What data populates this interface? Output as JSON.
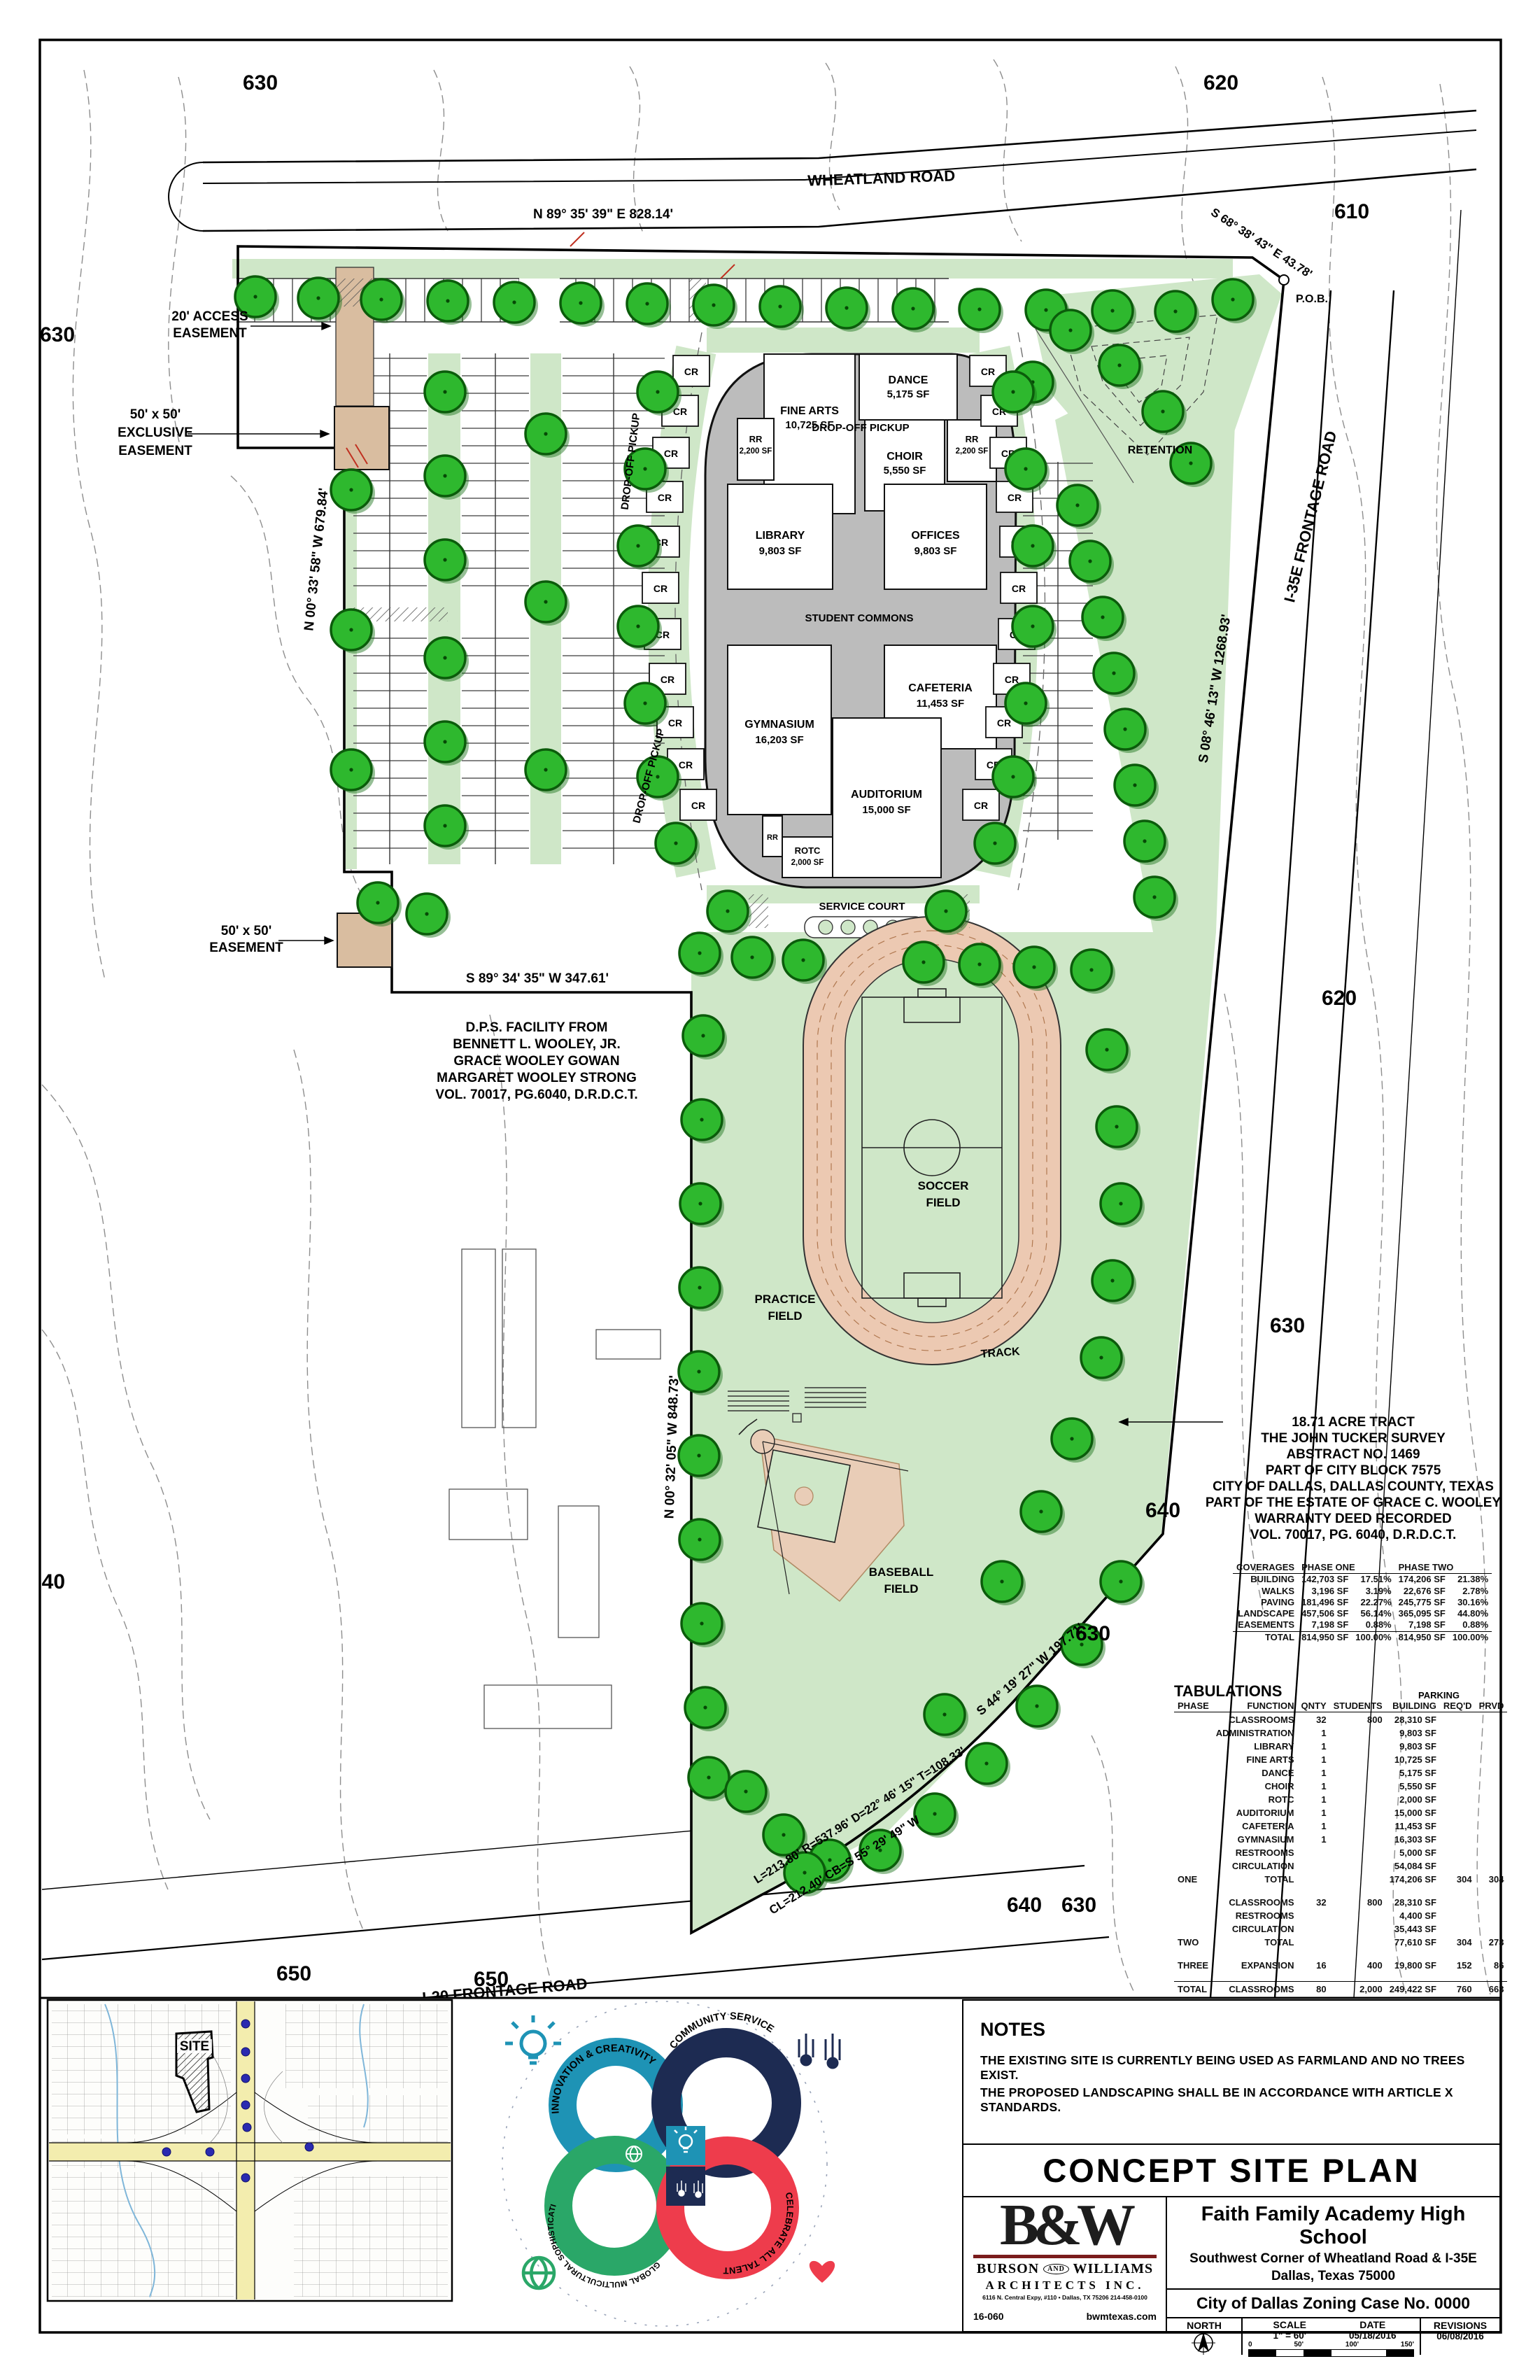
{
  "plan": {
    "roads": {
      "wheatland": "WHEATLAND ROAD",
      "i35e": "I-35E FRONTAGE ROAD",
      "i20": "I-20  FRONTAGE ROAD"
    },
    "bearings": {
      "north": "N 89° 35' 39\" E    828.14'",
      "northeast": "S 68° 38' 43\" E   43.78'",
      "pob": "P.O.B.",
      "east": "S 08° 46' 13\" W    1268.93'",
      "west_north": "N 00° 33' 58\" W    679.84'",
      "mid": "S 89° 34' 35\" W    347.61'",
      "west_south": "N 00° 32' 05\" W    848.73'",
      "southeast": "S 44° 19' 27\" W   197.71'",
      "curve1": "L=213.80'    R=537.96'    D=22° 46' 15\"    T=108.33'",
      "curve2": "CL=212.40'    CB=S 55° 29' 49\" W"
    },
    "contours": [
      "630",
      "620",
      "610",
      "630",
      "620",
      "630",
      "640",
      "630",
      "640",
      "650",
      "650",
      "640",
      "630"
    ],
    "easements": {
      "access1": "20' AC­CESS",
      "access2": "EASEMENT",
      "exclusive1": "50' x 50'",
      "exclusive2": "EXCLUSIVE",
      "exclusive3": "EASEMENT",
      "plain1": "50' x 50'",
      "plain2": "EASEMENT"
    },
    "features": {
      "retention": "RETENTION",
      "drop_off": "DROP-OFF PICKUP",
      "service_court": "SERVICE COURT",
      "practice1": "PRACTICE",
      "practice2": "FIELD",
      "soccer1": "SOCCER",
      "soccer2": "FIELD",
      "track": "TRACK",
      "baseball1": "BASEBALL",
      "baseball2": "FIELD"
    },
    "buildings": {
      "classroom": "CR",
      "fine_arts": {
        "name": "FINE ARTS",
        "area": "10,725 SF"
      },
      "dance": {
        "name": "DANCE",
        "area": "5,175 SF"
      },
      "rr_left": {
        "name": "RR",
        "area": "2,200 SF"
      },
      "choir": {
        "name": "CHOIR",
        "area": "5,550 SF"
      },
      "rr_right": {
        "name": "RR",
        "area": "2,200 SF"
      },
      "library": {
        "name": "LIBRARY",
        "area": "9,803 SF"
      },
      "offices": {
        "name": "OFFICES",
        "area": "9,803 SF"
      },
      "student_commons": {
        "name": "STUDENT COMMONS"
      },
      "gymnasium": {
        "name": "GYMNASIUM",
        "area": "16,203 SF"
      },
      "cafeteria": {
        "name": "CAFETERIA",
        "area": "11,453 SF"
      },
      "auditorium": {
        "name": "AUDITORIUM",
        "area": "15,000 SF"
      },
      "rr_small": {
        "name": "RR"
      },
      "rotc": {
        "name": "ROTC",
        "area": "2,000 SF"
      }
    },
    "dps_note": [
      "D.P.S. FACILITY FROM",
      "BENNETT L. WOOLEY, JR.",
      "GRACE WOOLEY GOWAN",
      "MARGARET WOOLEY STRONG",
      "VOL. 70017, PG.6040, D.R.D.C.T."
    ],
    "tract_note": [
      "18.71 ACRE TRACT",
      "THE JOHN TUCKER SURVEY",
      "ABSTRACT NO. 1469",
      "PART OF CITY BLOCK 7575",
      "CITY OF DALLAS, DALLAS COUNTY, TEXAS",
      "PART OF THE ESTATE OF GRACE C. WOOLEY",
      "WARRANTY DEED RECORDED",
      "VOL. 70017, PG. 6040, D.R.D.C.T."
    ]
  },
  "coverages": {
    "title": "COVERAGES",
    "phase_one": "PHASE ONE",
    "phase_two": "PHASE TWO",
    "rows": [
      {
        "label": "BUILDING",
        "p1sf": "142,703 SF",
        "p1pct": "17.51%",
        "p2sf": "174,206 SF",
        "p2pct": "21.38%"
      },
      {
        "label": "WALKS",
        "p1sf": "3,196 SF",
        "p1pct": "3.19%",
        "p2sf": "22,676 SF",
        "p2pct": "2.78%"
      },
      {
        "label": "PAVING",
        "p1sf": "181,496 SF",
        "p1pct": "22.27%",
        "p2sf": "245,775 SF",
        "p2pct": "30.16%"
      },
      {
        "label": "LANDSCAPE",
        "p1sf": "457,506 SF",
        "p1pct": "56.14%",
        "p2sf": "365,095 SF",
        "p2pct": "44.80%"
      },
      {
        "label": "EASEMENTS",
        "p1sf": "7,198 SF",
        "p1pct": "0.88%",
        "p2sf": "7,198 SF",
        "p2pct": "0.88%"
      }
    ],
    "total": {
      "label": "TOTAL",
      "p1sf": "814,950 SF",
      "p1pct": "100.00%",
      "p2sf": "814,950 SF",
      "p2pct": "100.00%"
    }
  },
  "tabulations": {
    "title": "TABULATIONS",
    "parking": "PARKING",
    "headers": {
      "phase": "PHASE",
      "function": "FUNCTION",
      "qnty": "QNTY",
      "students": "STUDENTS",
      "building": "BUILDING",
      "reqd": "REQ'D",
      "prvd": "PRVD"
    },
    "phase_one_rows": [
      {
        "fn": "CLASSROOMS",
        "qnty": "32",
        "students": "800",
        "building": "28,310 SF"
      },
      {
        "fn": "ADMINISTRATION",
        "qnty": "1",
        "students": "",
        "building": "9,803 SF"
      },
      {
        "fn": "LIBRARY",
        "qnty": "1",
        "students": "",
        "building": "9,803 SF"
      },
      {
        "fn": "FINE ARTS",
        "qnty": "1",
        "students": "",
        "building": "10,725 SF"
      },
      {
        "fn": "DANCE",
        "qnty": "1",
        "students": "",
        "building": "5,175 SF"
      },
      {
        "fn": "CHOIR",
        "qnty": "1",
        "students": "",
        "building": "5,550 SF"
      },
      {
        "fn": "ROTC",
        "qnty": "1",
        "students": "",
        "building": "2,000 SF"
      },
      {
        "fn": "AUDITORIUM",
        "qnty": "1",
        "students": "",
        "building": "15,000 SF"
      },
      {
        "fn": "CAFETERIA",
        "qnty": "1",
        "students": "",
        "building": "11,453 SF"
      },
      {
        "fn": "GYMNASIUM",
        "qnty": "1",
        "students": "",
        "building": "16,303 SF"
      },
      {
        "fn": "RESTROOMS",
        "qnty": "",
        "students": "",
        "building": "5,000 SF"
      },
      {
        "fn": "CIRCULATION",
        "qnty": "",
        "students": "",
        "building": "54,084 SF"
      }
    ],
    "phase_one_total": {
      "phase": "ONE",
      "fn": "TOTAL",
      "building": "174,206 SF",
      "reqd": "304",
      "prvd": "304"
    },
    "phase_two_rows": [
      {
        "fn": "CLASSROOMS",
        "qnty": "32",
        "students": "800",
        "building": "28,310 SF"
      },
      {
        "fn": "RESTROOMS",
        "qnty": "",
        "students": "",
        "building": "4,400 SF"
      },
      {
        "fn": "CIRCULATION",
        "qnty": "",
        "students": "",
        "building": "35,443 SF"
      }
    ],
    "phase_two_total": {
      "phase": "TWO",
      "fn": "TOTAL",
      "building": "77,610 SF",
      "reqd": "304",
      "prvd": "273"
    },
    "phase_three": {
      "phase": "THREE",
      "fn": "EXPANSION",
      "qnty": "16",
      "students": "400",
      "building": "19,800 SF",
      "reqd": "152",
      "prvd": "86"
    },
    "grand_total": {
      "phase": "TOTAL",
      "fn": "CLASSROOMS",
      "qnty": "80",
      "students": "2,000",
      "building": "249,422 SF",
      "reqd": "760",
      "prvd": "663"
    }
  },
  "notes": {
    "title": "NOTES",
    "line1": "THE EXISTING SITE IS CURRENTLY BEING USED AS FARMLAND AND NO TREES EXIST.",
    "line2": "THE PROPOSED LANDSCAPING SHALL BE IN ACCORDANCE WITH ARTICLE X STANDARDS."
  },
  "title_block": {
    "sheet_title": "CONCEPT SITE PLAN",
    "firm": {
      "initials": "B&W",
      "name_left": "BURSON",
      "name_and": "AND",
      "name_right": "WILLIAMS",
      "line2": "ARCHITECTS INC.",
      "address": "6116 N. Central Expy, #110 • Dallas, TX 75206   214-458-0100",
      "job_no": "16-060",
      "website": "bwmtexas.com"
    },
    "project": {
      "name": "Faith Family Academy High School",
      "address1": "Southwest Corner of Wheatland Road & I-35E",
      "address2": "Dallas, Texas  75000",
      "case_no": "City of Dallas Zoning Case No. 0000"
    },
    "north_label": "NORTH",
    "scale_label": "SCALE",
    "scale_value": "1\" = 60'",
    "date_label": "DATE",
    "date_value": "05/18/2016",
    "revisions_label": "REVISIONS",
    "revisions_value": "06/08/2016",
    "scalebar": [
      "0",
      "50'",
      "100'",
      "150'"
    ]
  },
  "inset_map": {
    "site_label": "SITE"
  },
  "logo": {
    "rings": [
      {
        "label": "INNOVATION & CREATIVITY",
        "color": "#1e93b5"
      },
      {
        "label": "COMMUNITY SERVICE",
        "color": "#1d2b52"
      },
      {
        "label": "GLOBAL MULTICULTURAL SOPHISTICATION",
        "color": "#2aa768"
      },
      {
        "label": "CELEBRATE ALL TALENTS",
        "color": "#ee3c4c"
      }
    ]
  }
}
